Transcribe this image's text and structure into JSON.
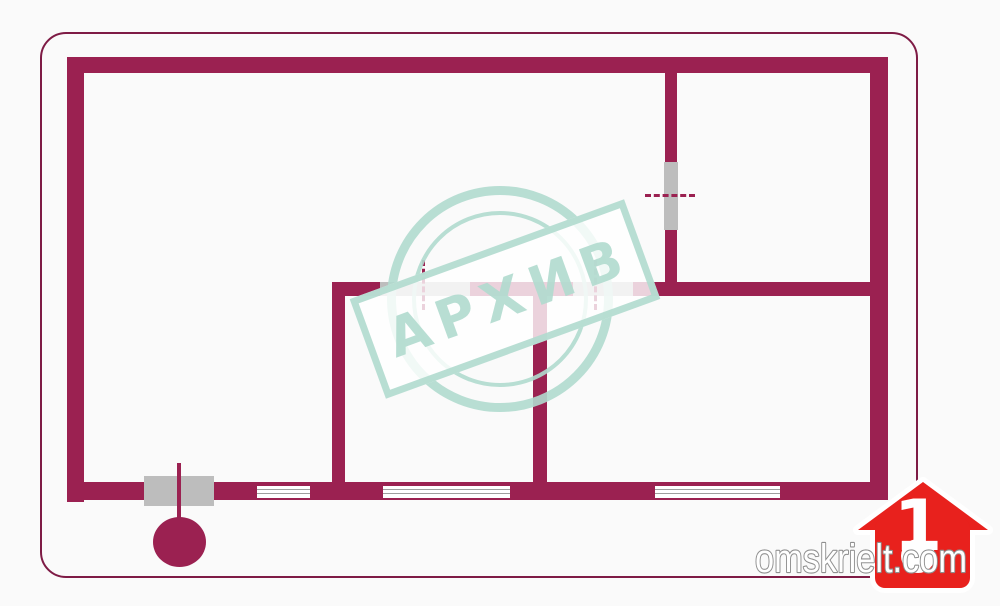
{
  "watermark": {
    "text": "АРХИВ"
  },
  "brand": {
    "site": "omskrielt.com",
    "logo_number": "1"
  },
  "colors": {
    "background": "#fafafa",
    "wall": "#9b2151",
    "frame": "#7e1b45",
    "door": "#bdbdbd",
    "window_line": "#9e9e9e",
    "stamp_teal": "rgba(176,218,206,0.9)",
    "logo_red": "#e8211d",
    "text_stroke": "#8f8f8f"
  },
  "plan": {
    "walls": [
      {
        "x": 67,
        "y": 57,
        "w": 821,
        "h": 16
      },
      {
        "x": 67,
        "y": 57,
        "w": 17,
        "h": 445
      },
      {
        "x": 870,
        "y": 57,
        "w": 18,
        "h": 443
      },
      {
        "x": 67,
        "y": 482,
        "w": 821,
        "h": 18
      },
      {
        "x": 665,
        "y": 73,
        "w": 12,
        "h": 223
      },
      {
        "x": 332,
        "y": 282,
        "w": 538,
        "h": 14
      },
      {
        "x": 332,
        "y": 282,
        "w": 13,
        "h": 218
      },
      {
        "x": 533,
        "y": 296,
        "w": 14,
        "h": 186
      }
    ],
    "doors": [
      {
        "x": 664,
        "y": 162,
        "w": 14,
        "h": 68
      },
      {
        "x": 380,
        "y": 282,
        "w": 90,
        "h": 14
      },
      {
        "x": 573,
        "y": 282,
        "w": 60,
        "h": 14
      },
      {
        "x": 144,
        "y": 476,
        "w": 70,
        "h": 30
      }
    ],
    "windows": [
      {
        "x": 257,
        "y": 486,
        "w": 53,
        "h": 12
      },
      {
        "x": 383,
        "y": 486,
        "w": 127,
        "h": 12
      },
      {
        "x": 655,
        "y": 486,
        "w": 125,
        "h": 12
      }
    ],
    "door_markers": [
      {
        "dir": "v",
        "x": 422,
        "y": 260,
        "w": 0,
        "h": 50
      },
      {
        "dir": "v",
        "x": 594,
        "y": 260,
        "w": 0,
        "h": 50
      },
      {
        "dir": "h",
        "x": 645,
        "y": 194,
        "w": 50,
        "h": 0
      }
    ],
    "entrance": {
      "line": {
        "x": 177,
        "y": 463,
        "w": 4,
        "h": 56
      },
      "circle": {
        "x": 153,
        "y": 517,
        "w": 53,
        "h": 50
      }
    }
  }
}
